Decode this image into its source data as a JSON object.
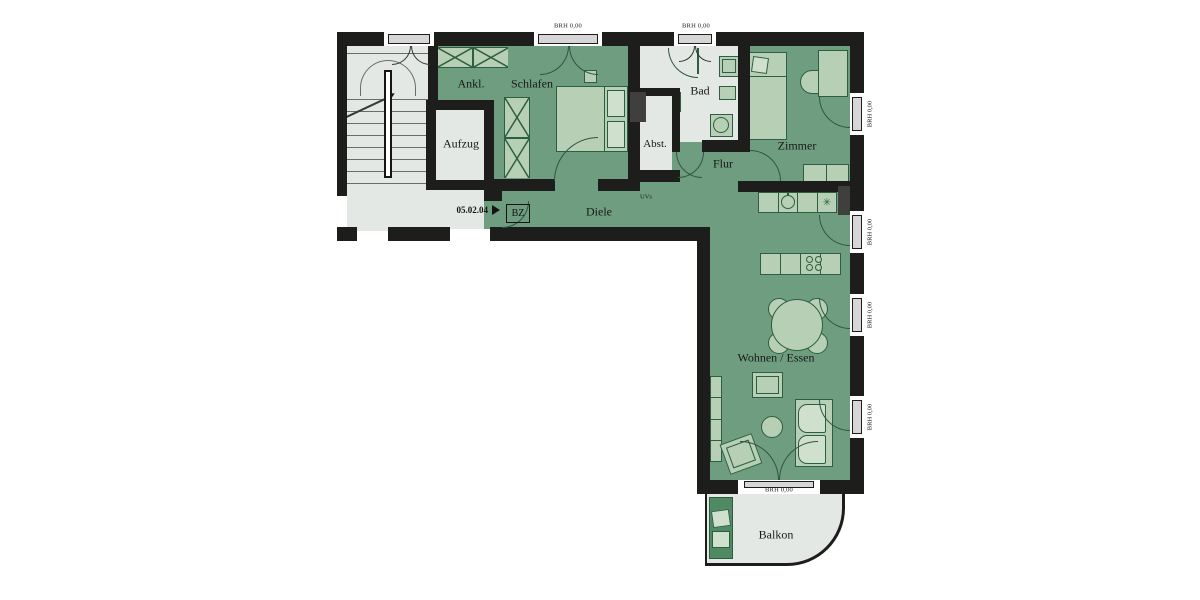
{
  "plan": {
    "unit_number": "05.02.04",
    "entry_badge": "BZ",
    "sill_label": "BRH 0,00",
    "rooms": {
      "ankleide": "Ankl.",
      "schlafen": "Schlafen",
      "bad": "Bad",
      "zimmer": "Zimmer",
      "aufzug": "Aufzug",
      "abstellraum": "Abst.",
      "flur": "Flur",
      "diele": "Diele",
      "uvs": "UVs",
      "wohnen_essen": "Wohnen / Essen",
      "balkon": "Balkon"
    },
    "symbols": {
      "stove": "✳"
    },
    "colors": {
      "wall": "#1d1d1b",
      "room_green": "#6f9d80",
      "room_gray": "#e4e8e4",
      "furniture_fill": "#b6cfb5",
      "furniture_light": "#cfe0cd",
      "furniture_line": "#2d5e41",
      "window_fill": "#d6d6d6",
      "balcony_chair": "#4f8a63",
      "stair_line": "#6b6b6b",
      "arc_line": "#2f5540",
      "shaft_gray": "#3f3f3d"
    }
  }
}
